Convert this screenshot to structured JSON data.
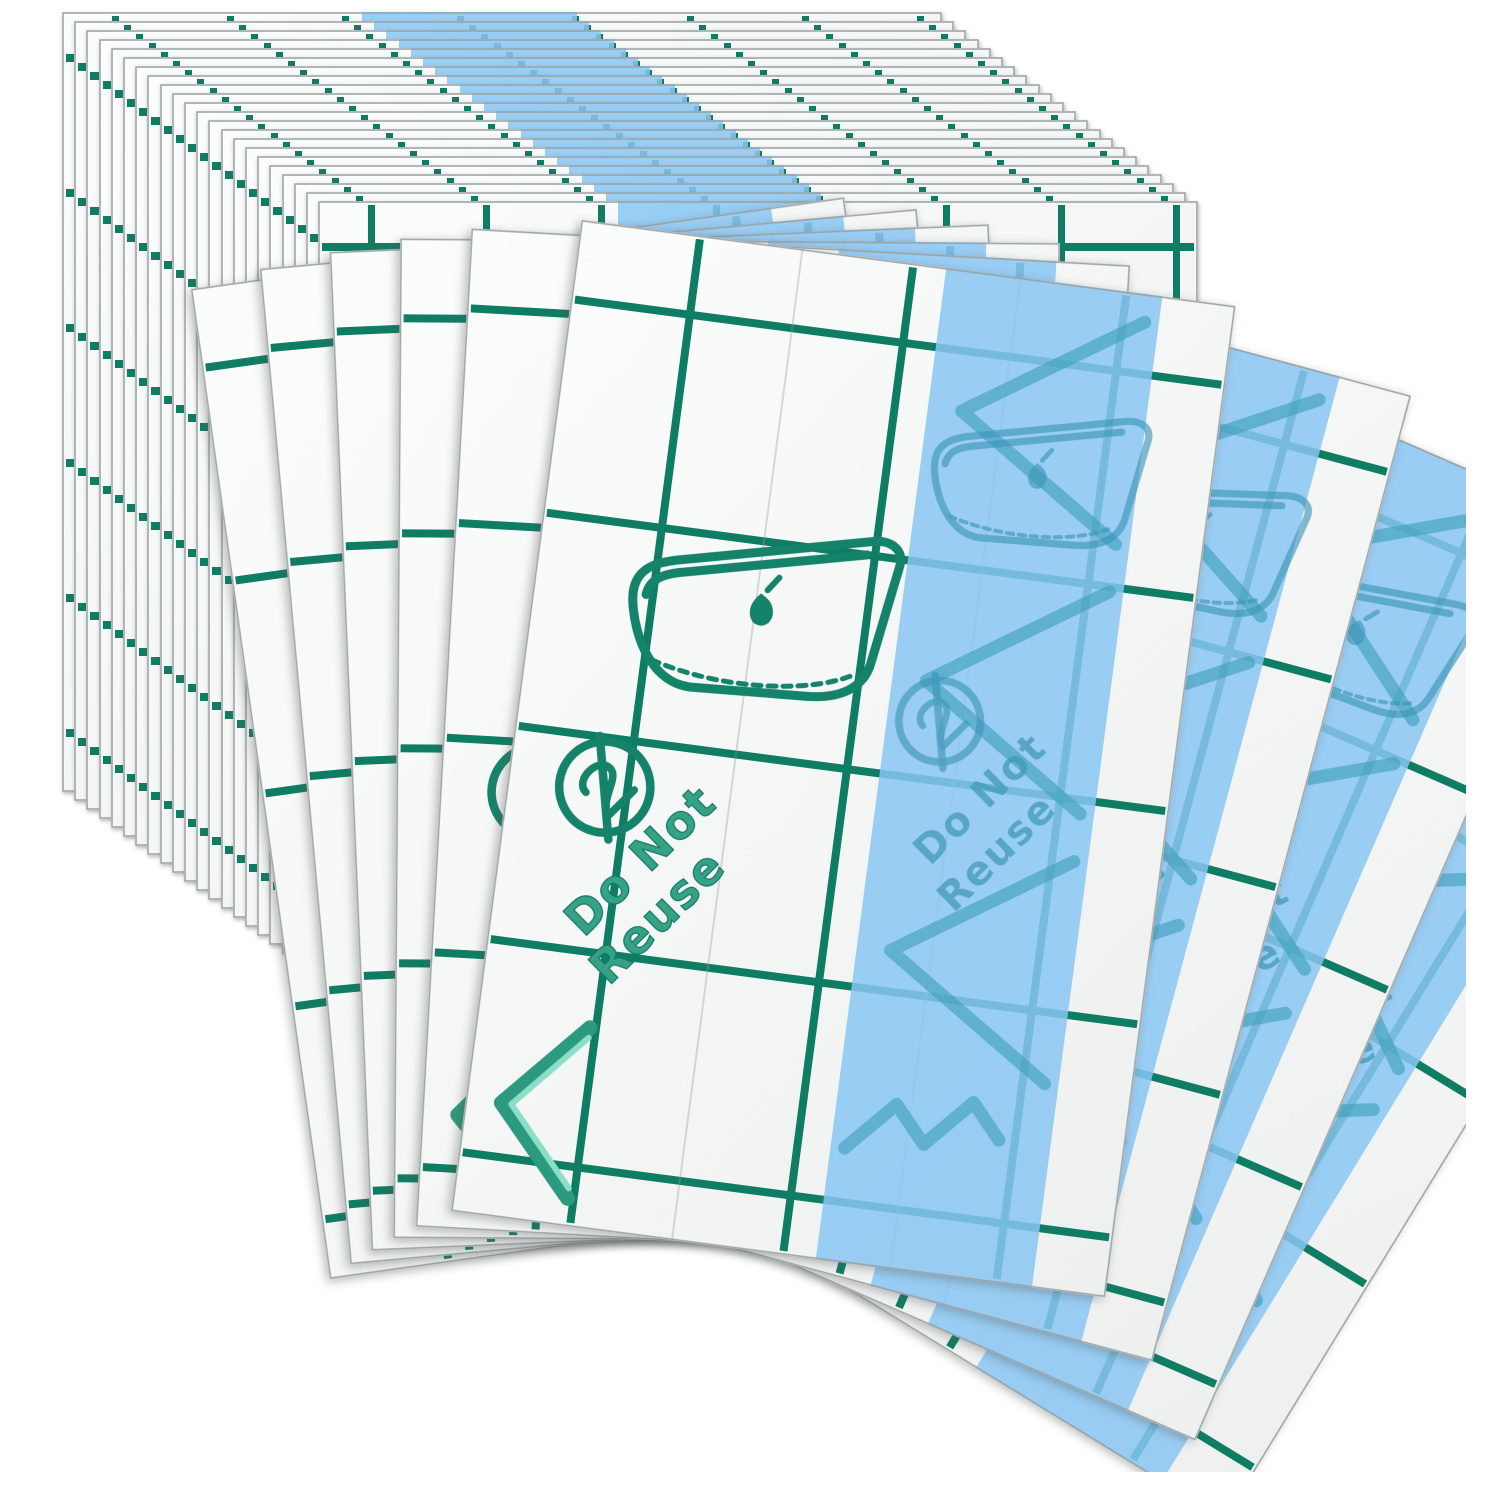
{
  "scene": {
    "background": "#ffffff",
    "description_labels": {
      "do_not_reuse_line1": "Do Not",
      "do_not_reuse_line2": "Reuse"
    },
    "sheets": {
      "back_stack_count": 22,
      "fan_count": 9,
      "surface_color": "#f5f6f6",
      "grid_color": "#0e7d63",
      "stripe_color": "#88c6f3",
      "emblem_color": "#1f9579",
      "stripe_mark_color": "#3e9ebc",
      "edge_color": "#9aa0a0"
    },
    "icons": [
      "iron-icon",
      "do-not-reuse-icon",
      "chevron-icon",
      "arrow-chevron-marks"
    ]
  }
}
